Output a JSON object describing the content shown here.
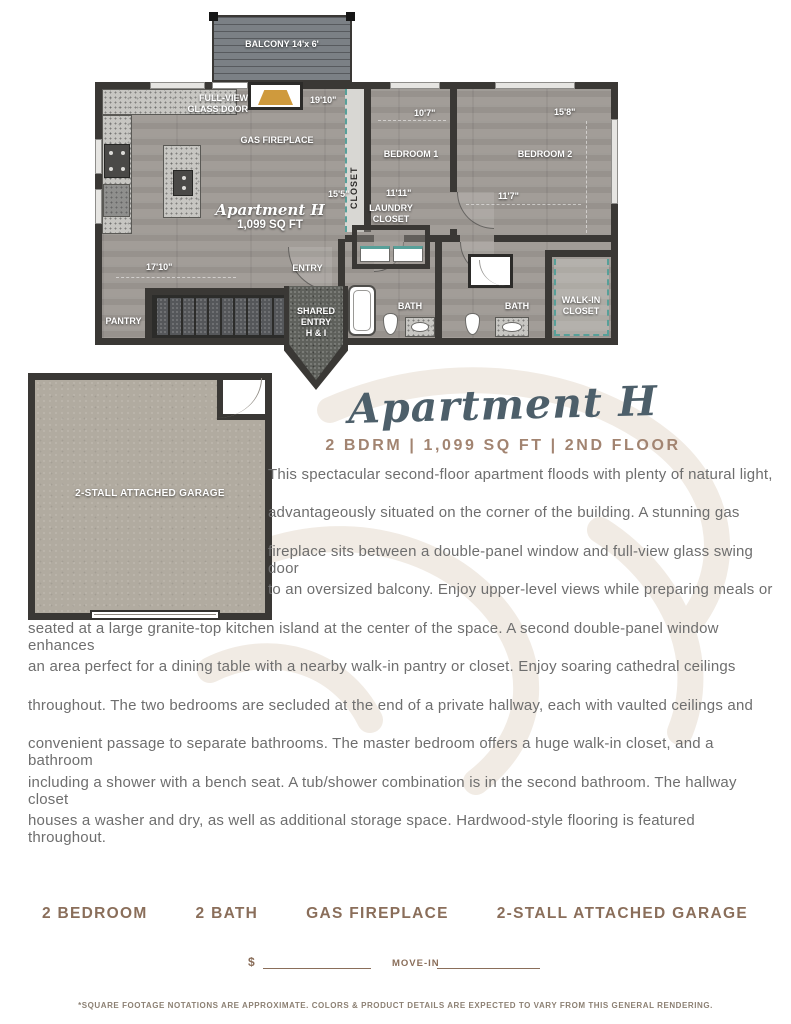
{
  "header": {
    "title": "Apartment H",
    "subtitle": "2 BDRM  |  1,099 SQ FT  |  2ND FLOOR"
  },
  "floor_plan": {
    "balcony_label": "BALCONY 14'x 6'",
    "apartment_label": "Apartment H",
    "apartment_sqft": "1,099 SQ FT",
    "rooms": {
      "full_view_glass_door": "FULL-VIEW\nGLASS DOOR",
      "gas_fireplace": "GAS FIREPLACE",
      "closet": "CLOSET",
      "bedroom_1": "BEDROOM 1",
      "bedroom_2": "BEDROOM 2",
      "laundry_closet": "LAUNDRY\nCLOSET",
      "bath_1": "BATH",
      "bath_2": "BATH",
      "walk_in_closet": "WALK-IN\nCLOSET",
      "pantry": "PANTRY",
      "entry": "ENTRY",
      "shared_entry": "SHARED\nENTRY\nH & I"
    },
    "dimensions": {
      "living_width": "19'10\"",
      "living_depth": "15'5\"",
      "kitchen_width": "17'10\"",
      "bedroom_1_width": "10'7\"",
      "bedroom_1_depth": "11'11\"",
      "bedroom_2_depth": "15'8\"",
      "bedroom_2_width": "11'7\""
    }
  },
  "garage": {
    "label": "2-STALL ATTACHED GARAGE"
  },
  "description": {
    "lines": [
      "This spectacular second-floor apartment floods with plenty of natural light,",
      "advantageously situated on the corner of the building. A stunning gas",
      "fireplace sits between a double-panel window and full-view glass swing door",
      "to an oversized balcony. Enjoy upper-level views while preparing meals or",
      "seated at a large granite-top kitchen island at the center of the space. A second double-panel window enhances",
      "an area perfect for a dining table with a nearby walk-in pantry or closet. Enjoy soaring cathedral ceilings",
      "throughout. The two bedrooms are secluded at the end of a private hallway, each with vaulted ceilings and",
      "convenient passage to separate bathrooms. The master bedroom offers a huge walk-in closet, and a bathroom",
      "including a shower with a bench seat. A tub/shower combination is in the second bathroom. The hallway closet",
      "houses a washer and dry, as well as additional storage space. Hardwood-style flooring is featured throughout."
    ]
  },
  "features": [
    "2 BEDROOM",
    "2 BATH",
    "GAS FIREPLACE",
    "2-STALL ATTACHED GARAGE"
  ],
  "pricing": {
    "currency_symbol": "$",
    "move_in_label": "MOVE-IN"
  },
  "footnote": "*SQUARE FOOTAGE NOTATIONS ARE APPROXIMATE. COLORS & PRODUCT DETAILS ARE EXPECTED TO VARY FROM THIS GENERAL RENDERING.",
  "colors": {
    "title": "#4d5f6a",
    "subtitle": "#a28471",
    "body_text": "#6e6e6e",
    "features": "#8a6e5a",
    "wall": "#3a3835",
    "closet_accent_teal": "#57a099",
    "fireplace_accent": "#cf9a3d",
    "watermark": "#f1ebe4"
  }
}
